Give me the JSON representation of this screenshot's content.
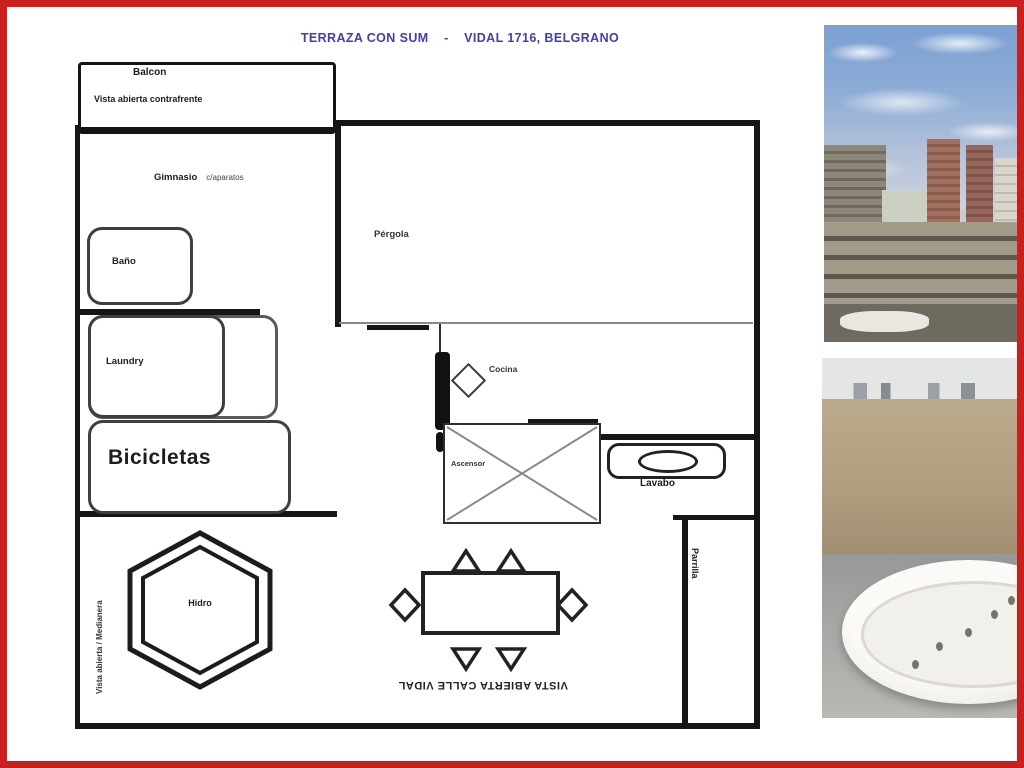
{
  "title": "TERRAZA CON SUM    -    VIDAL 1716, BELGRANO",
  "plan": {
    "balcony_label": "Balcon",
    "balcony_note": "Vista abierta contrafrente",
    "gym_label": "Gimnasio",
    "gym_note": "c/aparatos",
    "bathroom_label": "Baño",
    "laundry_label": "Laundry",
    "bikes_label": "Bicicletas",
    "pergola_label": "Pérgola",
    "kitchen_label": "Cocina",
    "elevator_label": "Ascensor",
    "sink_label": "Lavabo",
    "grill_label": "Parrilla",
    "hydro_label": "Hidro",
    "side_note": "Vista abierta / Medianera",
    "street_note": "VISTA ABIERTA CALLE VIDAL"
  },
  "colors": {
    "frame-red": "#c9201d",
    "title-blue": "#4140a5",
    "wall-black": "#161616"
  }
}
